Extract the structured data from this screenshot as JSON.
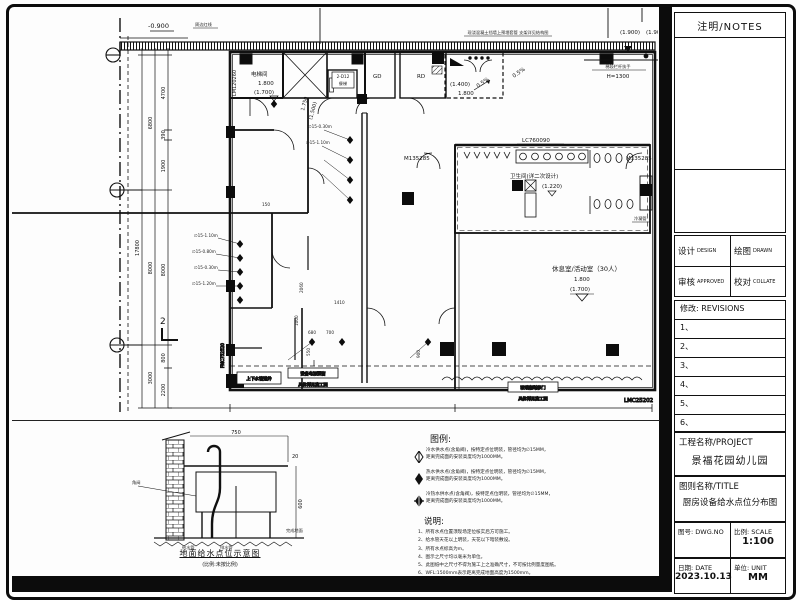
{
  "titleblock": {
    "notes_header": "注明/NOTES",
    "design_label": "设计",
    "design_en": "DESIGN",
    "drawn_label": "绘图",
    "drawn_en": "DRAWN",
    "approved_label": "审核",
    "approved_en": "APPROVED",
    "collate_label": "校对",
    "collate_en": "COLLATE",
    "revisions_label": "修改: REVISIONS",
    "revision_rows": [
      "1、",
      "2、",
      "3、",
      "4、",
      "5、",
      "6、"
    ],
    "project_label": "工程名称/PROJECT",
    "project_name": "景福花园幼儿园",
    "title_label": "图则名称/TITLE",
    "drawing_title": "厨房设备给水点位分布图",
    "dwgno_label": "图号: DWG.NO",
    "scale_label": "比例: SCALE",
    "scale_value": "1:100",
    "date_label": "日期: DATE",
    "date_value": "2023.10.13",
    "unit_label": "单位: UNIT",
    "unit_value": "MM"
  },
  "plan": {
    "labels": {
      "level_minus": "-0.900",
      "boundary": "周边红线",
      "wall_note": "现浇混凝土挡墙上预埋套管 支架详见结构图",
      "level_1900": "(1.900)",
      "level_1900b": "(1.900)",
      "handrail": "梯段栏杆扶手",
      "handrail_h": "H=1300",
      "elevator_room": "电梯间",
      "elev_1800": "1.800",
      "elev_1700": "(1.700)",
      "door_lm": "LM120260",
      "dumbwaiter_code": "2-D12",
      "dumbwaiter": "餐梯",
      "gd": "GD",
      "rd": "RD",
      "plat_1400": "(1.400)",
      "plat_1800": "1.800",
      "slope1": "0.5%",
      "slope2": "0.5%",
      "window_lc": "LC760090",
      "door_m1": "M135285",
      "door_m2": "M135285",
      "wc": "卫生间(详二次设计)",
      "wc_level": "(1.220)",
      "condensate": "冷凝管",
      "rest_room": "休息室/活动室（30人）",
      "rest_1800": "1.800",
      "rest_1700": "(1.700)",
      "pipe_shaft": "上下水管道井",
      "power_note1": "设备电源预留",
      "power_note2": "具体详见施工图",
      "glass_note1": "玻璃隔断移门",
      "glass_note2": "具体详见施工图",
      "window_lmc": "LMC25202",
      "door_fmc": "FMC752520",
      "section_no": "2",
      "rot_1750": "1.750",
      "rot_1500": "(1.500)",
      "wp1": "∅15-1.10m",
      "wp2": "∅15-0.80m",
      "wp3": "∅15-0.30m",
      "wp4": "∅15-1.20m",
      "wp5": "∅15-0.30m",
      "wp6": "∅15-1.10m"
    },
    "dims": {
      "d6800": "6800",
      "d17800": "17800",
      "d8000": "8000",
      "d3000": "3000",
      "d4700": "4700",
      "d390": "390",
      "d1900": "1900",
      "d8000b": "8000",
      "d800": "800",
      "d2200": "2200",
      "d2060": "2060",
      "d1410": "1410",
      "d680": "680",
      "d700": "700",
      "d550": "550",
      "d900": "900",
      "d150": "150",
      "d1000": "1000",
      "dh1300": "H=1300"
    }
  },
  "legend": {
    "title": "图例:",
    "items": [
      {
        "symbol": "cold-water-point",
        "line1": "冷水供水点(含角阀)，按特定点位明装，管径均为∅15MM，",
        "line2": "距离完成面的安装高度均为1000MM。"
      },
      {
        "symbol": "hot-water-point",
        "line1": "热水供水点(含角阀)，按特定点位明装，管径均为∅15MM，",
        "line2": "距离完成面的安装高度均为1000MM。"
      },
      {
        "symbol": "hot-cold-water-point",
        "line1": "冷热水供水点(含角阀)，按特定点位明装，管径均为∅15MM，",
        "line2": "距离完成面的安装高度均为1000MM。"
      }
    ]
  },
  "notes": {
    "title": "说明:",
    "items": [
      "1、所有水点位置须现场定位核实后方可施工。",
      "2、给水管天花以上明装，天花以下暗装敷设。",
      "3、所有水点标高为m。",
      "4、图示之尺寸均以毫米为单位。",
      "5、此图纸中之尺寸不得为施工上之准确尺寸，不可按比例量度图纸。",
      "6、WFL:1500mm表示距离完成地面高度为1500mm。"
    ]
  },
  "detail": {
    "caption": "地面给水点位示意图",
    "subcaption": "(比例:未按比例)",
    "labels": {
      "angle_valve": "角阀",
      "water_pipe": "给水管",
      "drain_pipe": "排水管",
      "floor": "完成地面",
      "dim750": "750",
      "dim600": "600",
      "dim20": "20"
    }
  }
}
